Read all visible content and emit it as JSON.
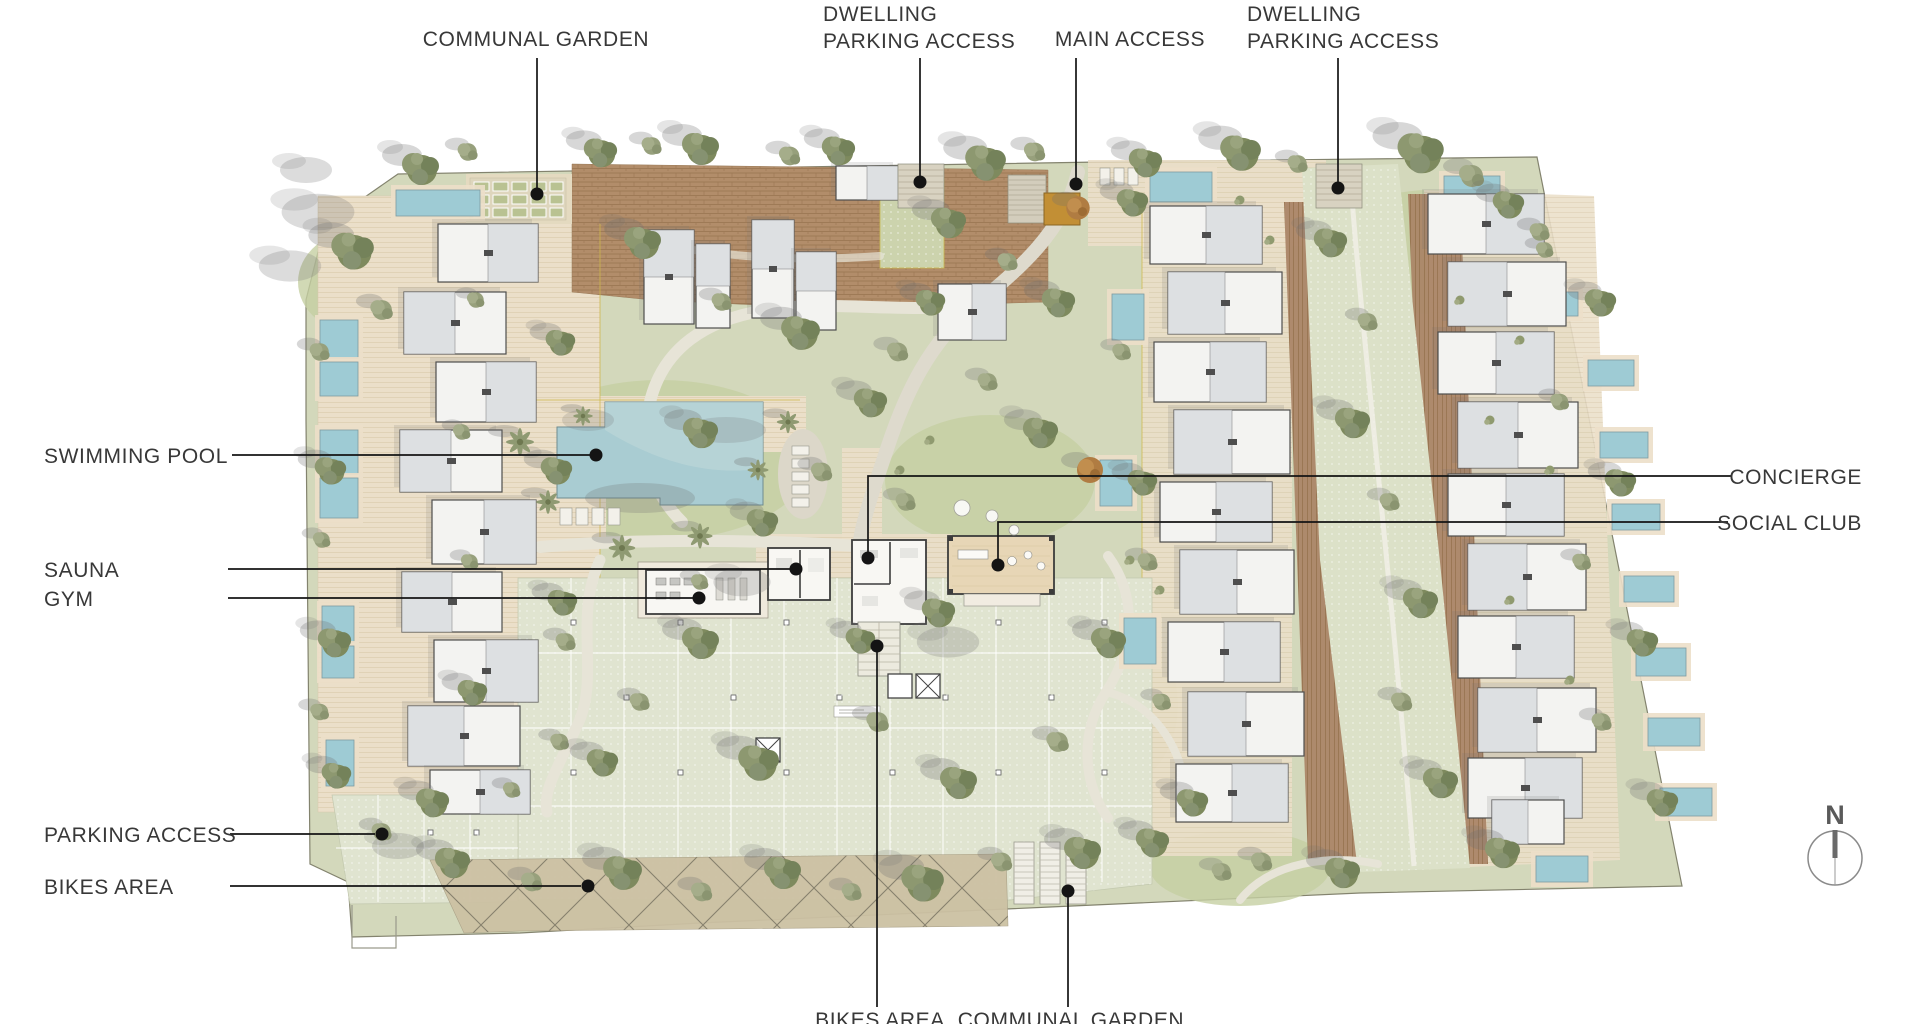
{
  "callouts": {
    "communal_garden_top": "COMMUNAL GARDEN",
    "dwelling_parking_left": {
      "line1": "DWELLING",
      "line2": "PARKING ACCESS"
    },
    "main_access": "MAIN ACCESS",
    "dwelling_parking_right": {
      "line1": "DWELLING",
      "line2": "PARKING ACCESS"
    },
    "swimming_pool": "SWIMMING POOL",
    "sauna": "SAUNA",
    "gym": "GYM",
    "concierge": "CONCIERGE",
    "social_club": "SOCIAL CLUB",
    "parking_access": "PARKING ACCESS",
    "bikes_area": "BIKES AREA",
    "bikes_area_bottom": "BIKES AREA",
    "communal_garden_bottom": "COMMUNAL GARDEN"
  },
  "compass": {
    "north_label": "N"
  },
  "palette": {
    "site_green": "#d3d8bb",
    "parking_green": "#e0e4d0",
    "deck_beige": "#ebdfc9",
    "deck_brown": "#b28d6a",
    "pool_blue": "#a9ccd2",
    "building_gray": "#f3f3f1",
    "tree_olive": "#7e8a5e",
    "label_text": "#383838",
    "leader_line": "#141414"
  }
}
